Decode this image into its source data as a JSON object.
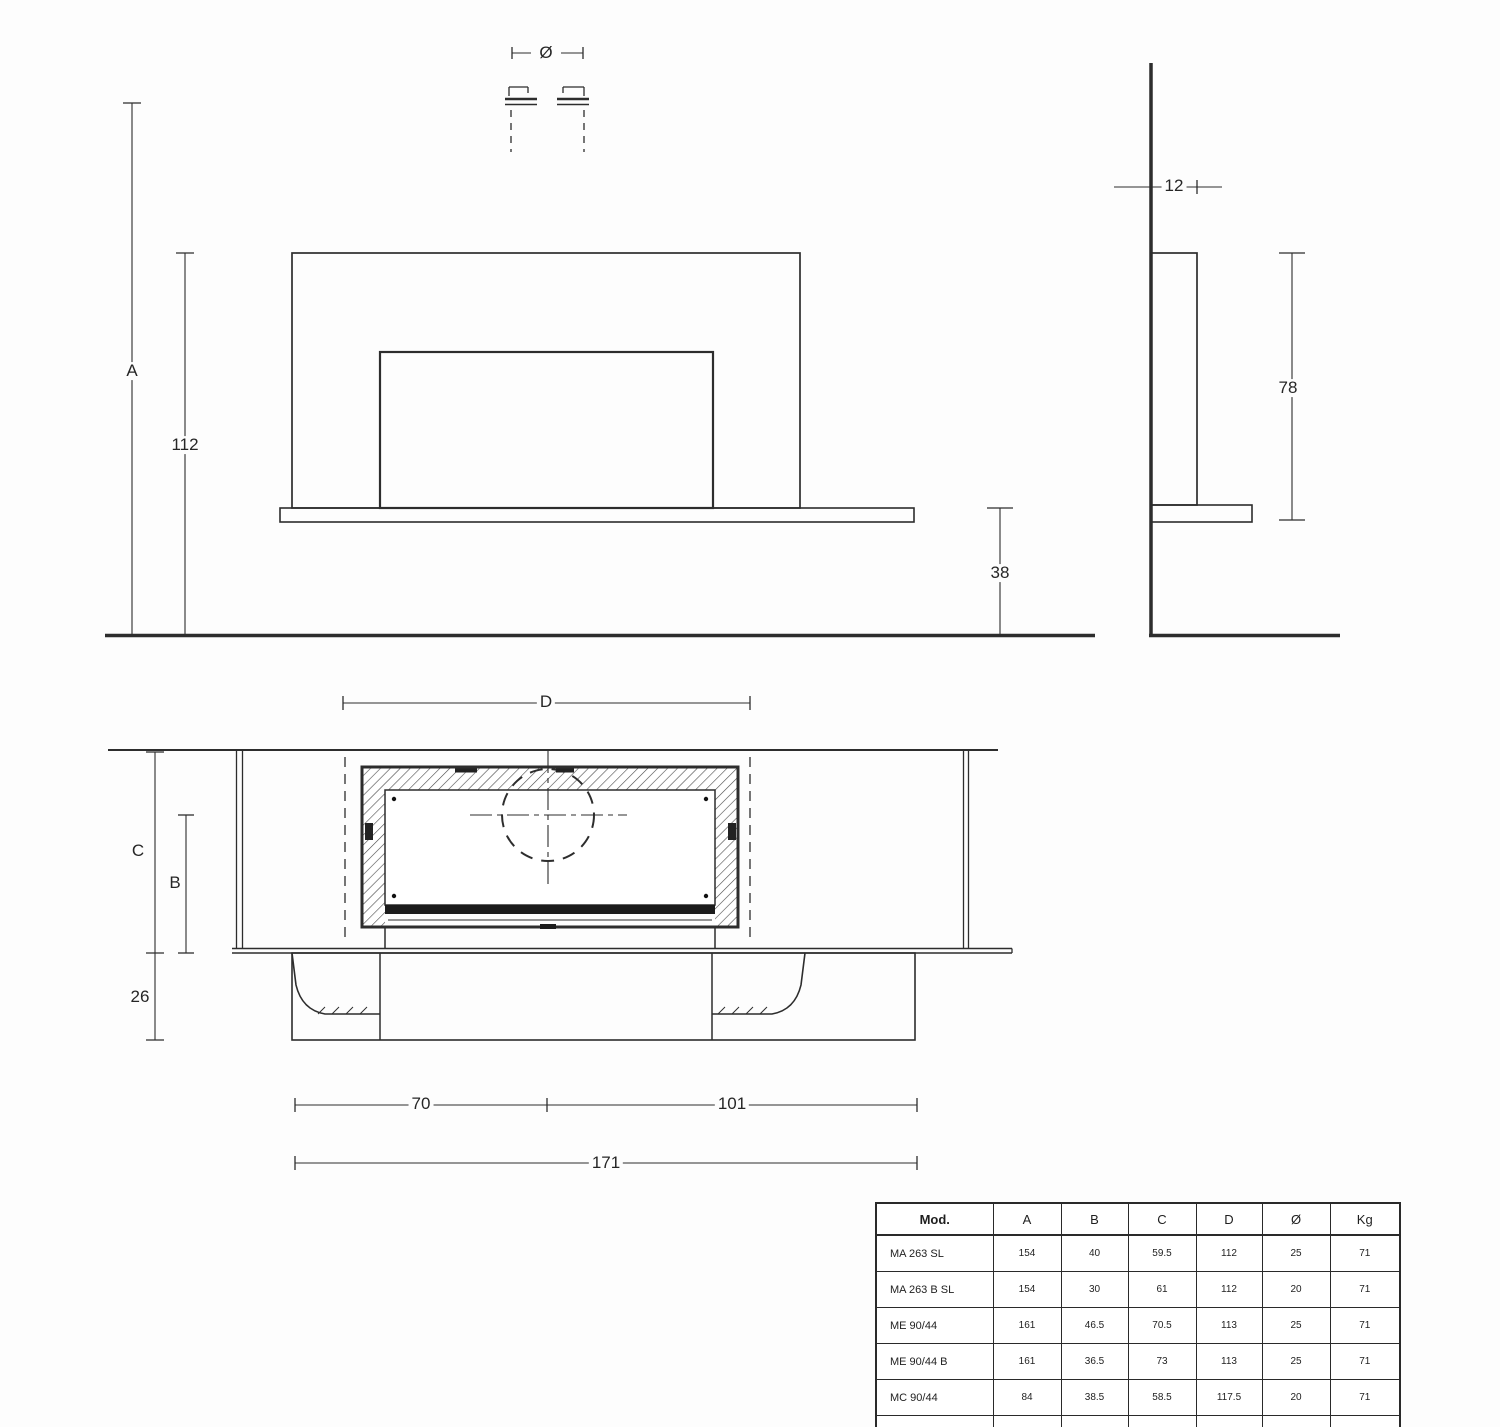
{
  "drawing": {
    "front_view": {
      "flue_diameter_symbol": "Ø",
      "overall_height_label": "A",
      "panel_top_height": "112",
      "bench_to_floor": "38"
    },
    "side_view": {
      "panel_depth": "12",
      "panel_height": "78"
    },
    "section_view": {
      "flue_span_label": "D",
      "top_height_label": "C",
      "firebox_height_label": "B",
      "plinth_height": "26",
      "left_width": "70",
      "right_width": "101",
      "overall_width": "171"
    }
  },
  "table": {
    "columns": [
      "Mod.",
      "A",
      "B",
      "C",
      "D",
      "Ø",
      "Kg"
    ],
    "rows": [
      [
        "MA 263 SL",
        "154",
        "40",
        "59.5",
        "112",
        "25",
        "71"
      ],
      [
        "MA 263 B SL",
        "154",
        "30",
        "61",
        "112",
        "20",
        "71"
      ],
      [
        "ME 90/44",
        "161",
        "46.5",
        "70.5",
        "113",
        "25",
        "71"
      ],
      [
        "ME 90/44 B",
        "161",
        "36.5",
        "73",
        "113",
        "25",
        "71"
      ],
      [
        "MC 90/44",
        "84",
        "38.5",
        "58.5",
        "117.5",
        "20",
        "71"
      ],
      [
        "IG 90",
        "91.5",
        "32.5",
        "50",
        "103",
        "15",
        "71"
      ]
    ]
  },
  "colors": {
    "line": "#2d2d2d",
    "background": "#fdfdfd"
  }
}
